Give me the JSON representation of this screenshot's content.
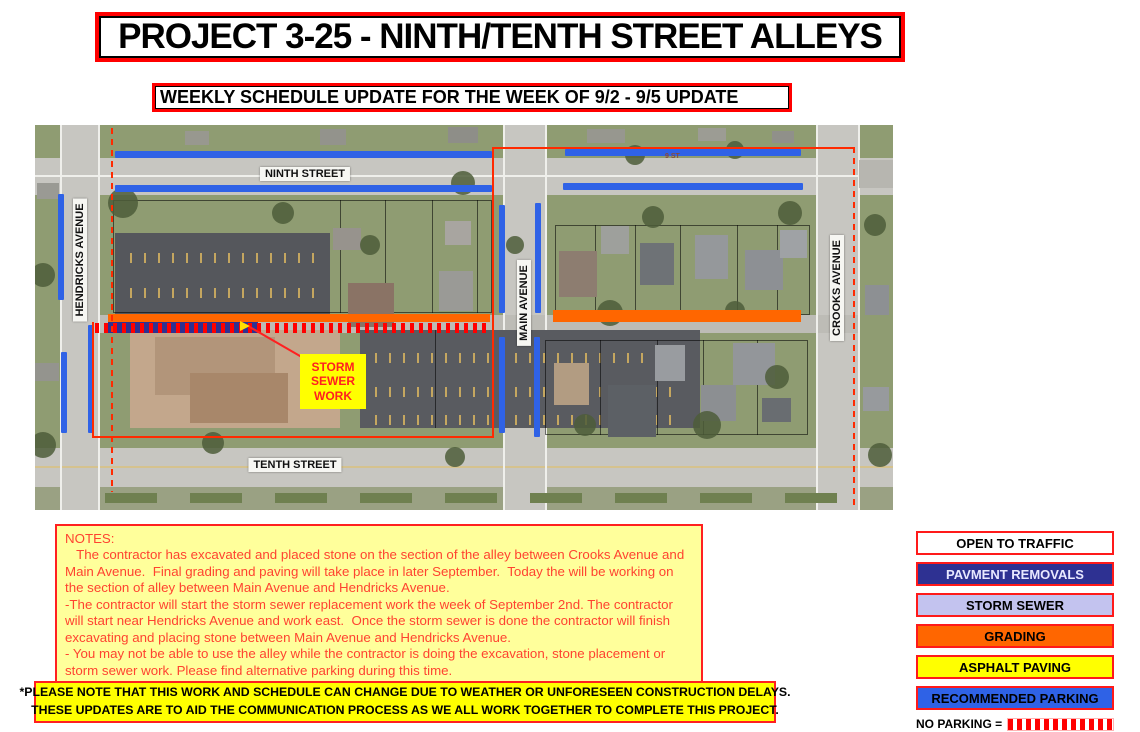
{
  "header": {
    "title": "PROJECT 3-25 - NINTH/TENTH STREET ALLEYS",
    "subtitle": "WEEKLY SCHEDULE UPDATE FOR THE WEEK OF 9/2 - 9/5 UPDATE"
  },
  "map": {
    "labels": {
      "ninth_street": "NINTH STREET",
      "tenth_street": "TENTH STREET",
      "hendricks_avenue": "HENDRICKS AVENUE",
      "main_avenue": "MAIN AVENUE",
      "crooks_avenue": "CROOKS AVENUE",
      "ninth_street_small": "9 ST",
      "storm_sewer_callout": "STORM SEWER WORK"
    },
    "overlay_colors": {
      "recommended_parking": "#2f62e6",
      "pavement_removal": "#2e3192",
      "grading": "#ff6600",
      "no_parking": "#ff0000",
      "project_boundary": "#ff2a00"
    }
  },
  "notes": {
    "title": "NOTES:",
    "paragraphs": [
      "   The contractor has excavated and placed stone on the section of the alley between Crooks Avenue and Main Avenue.  Final grading and paving will take place in later September.  Today the will be working on the section of alley between Main Avenue and Hendricks Avenue.",
      "-The contractor will start the storm sewer replacement work the week of September 2nd. The contractor will start near Hendricks Avenue and work east.  Once the storm sewer is done the contractor will finish excavating and placing stone between Main Avenue and Hendricks Avenue.",
      "- You may not be able to use the alley while the contractor is doing the excavation, stone placement or storm sewer work. Please find alternative parking during this time."
    ]
  },
  "disclaimer": {
    "line1": "*PLEASE NOTE THAT THIS WORK AND SCHEDULE CAN CHANGE DUE TO WEATHER OR UNFORESEEN CONSTRUCTION DELAYS.",
    "line2": "THESE UPDATES ARE TO AID THE COMMUNICATION PROCESS AS WE ALL WORK TOGETHER TO COMPLETE THIS PROJECT."
  },
  "legend": {
    "items": [
      {
        "label": "OPEN TO TRAFFIC",
        "bg": "#ffffff",
        "fg": "#000000"
      },
      {
        "label": "PAVMENT REMOVALS",
        "bg": "#2e3192",
        "fg": "#e8e8ff"
      },
      {
        "label": "STORM SEWER",
        "bg": "#c3c3ef",
        "fg": "#000000"
      },
      {
        "label": "GRADING",
        "bg": "#ff6600",
        "fg": "#000000"
      },
      {
        "label": "ASPHALT PAVING",
        "bg": "#ffff00",
        "fg": "#000000"
      },
      {
        "label": "RECOMMENDED PARKING",
        "bg": "#2f62e6",
        "fg": "#000000"
      }
    ],
    "no_parking_label": "NO PARKING ="
  }
}
